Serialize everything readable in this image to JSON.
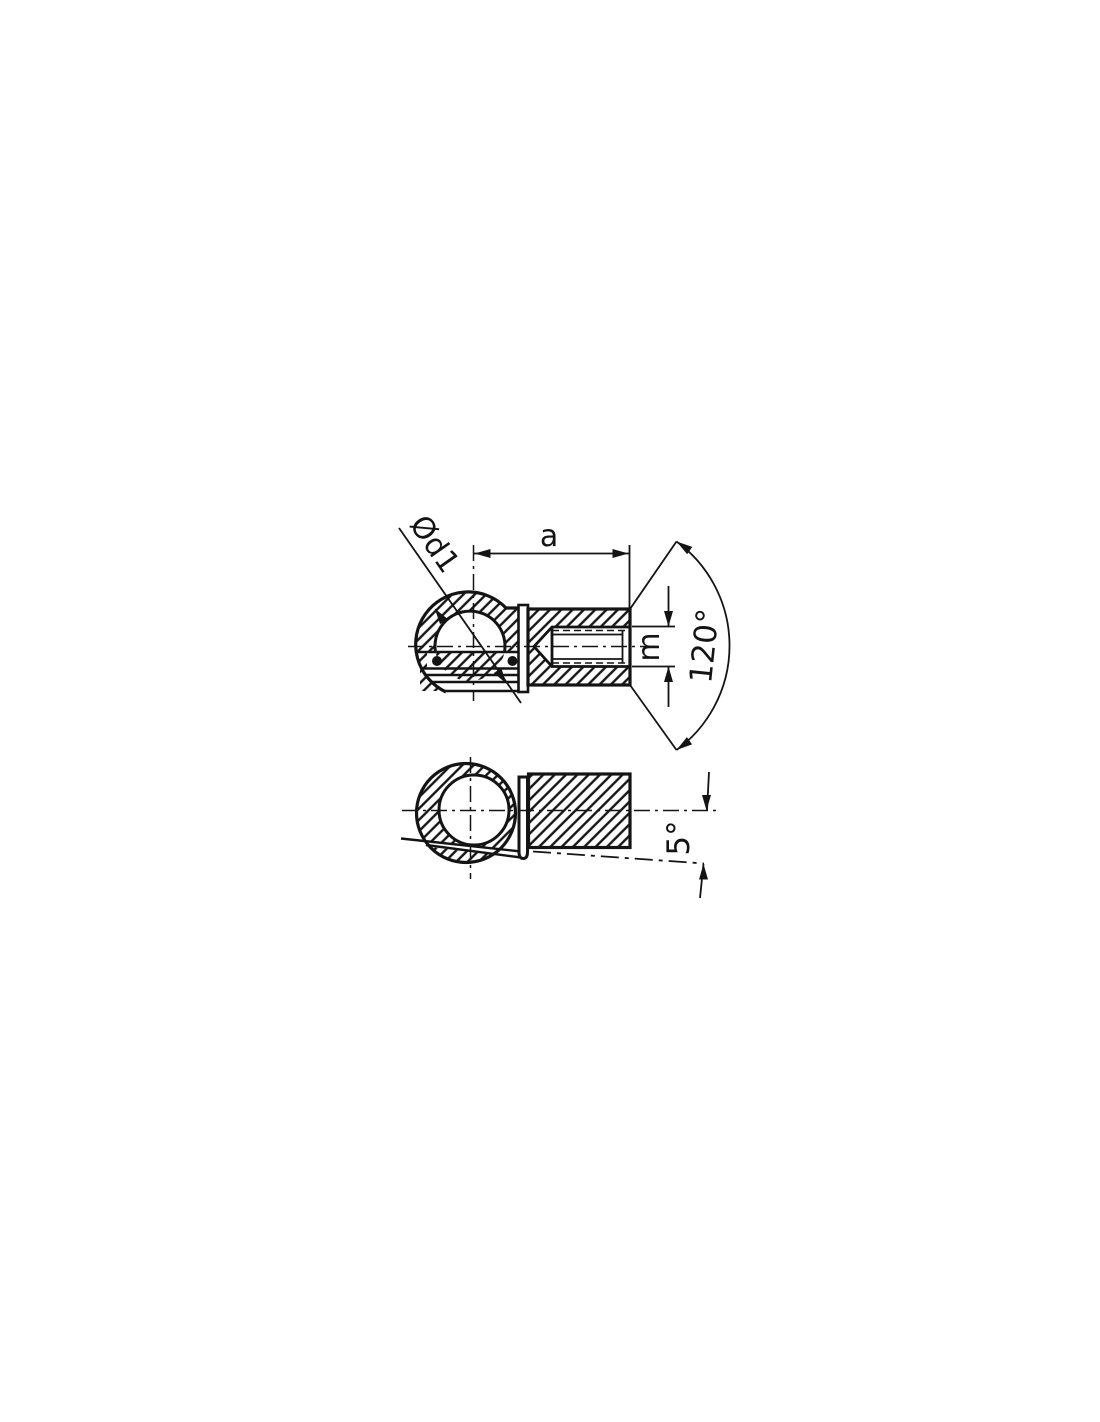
{
  "page": {
    "background": "#ffffff",
    "line_color": "#141414"
  },
  "drawing": {
    "name": "ball-socket-end-fitting-technical-drawing",
    "views": {
      "top": "sectioned ball cup with threaded sleeve",
      "bottom": "ring view with retaining clip and 5-degree swing line"
    },
    "labels": {
      "diameter": "Ød1",
      "length_a": "a",
      "thread_m": "m",
      "cone_angle": "120°",
      "swing_angle": "5°"
    }
  }
}
